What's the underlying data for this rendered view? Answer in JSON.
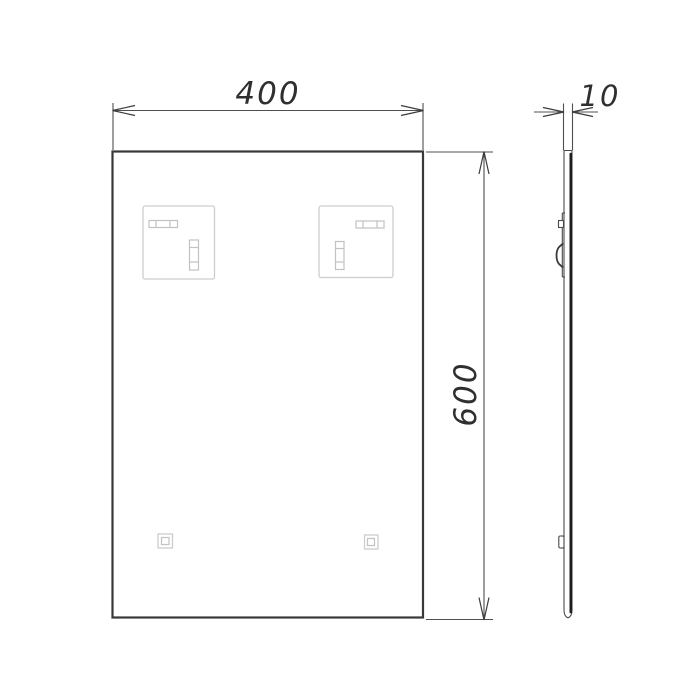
{
  "drawing": {
    "dimensions": {
      "width": {
        "value": "400"
      },
      "height": {
        "value": "600"
      },
      "thickness": {
        "value": "10"
      }
    },
    "colors": {
      "background": "#ffffff",
      "outline": "#383838",
      "dimension_lines": "#4f4f4f",
      "dimension_text": "#2f2f2f",
      "light_details": "#cdcdcd",
      "glass_edge": "#1e1e1e"
    }
  }
}
